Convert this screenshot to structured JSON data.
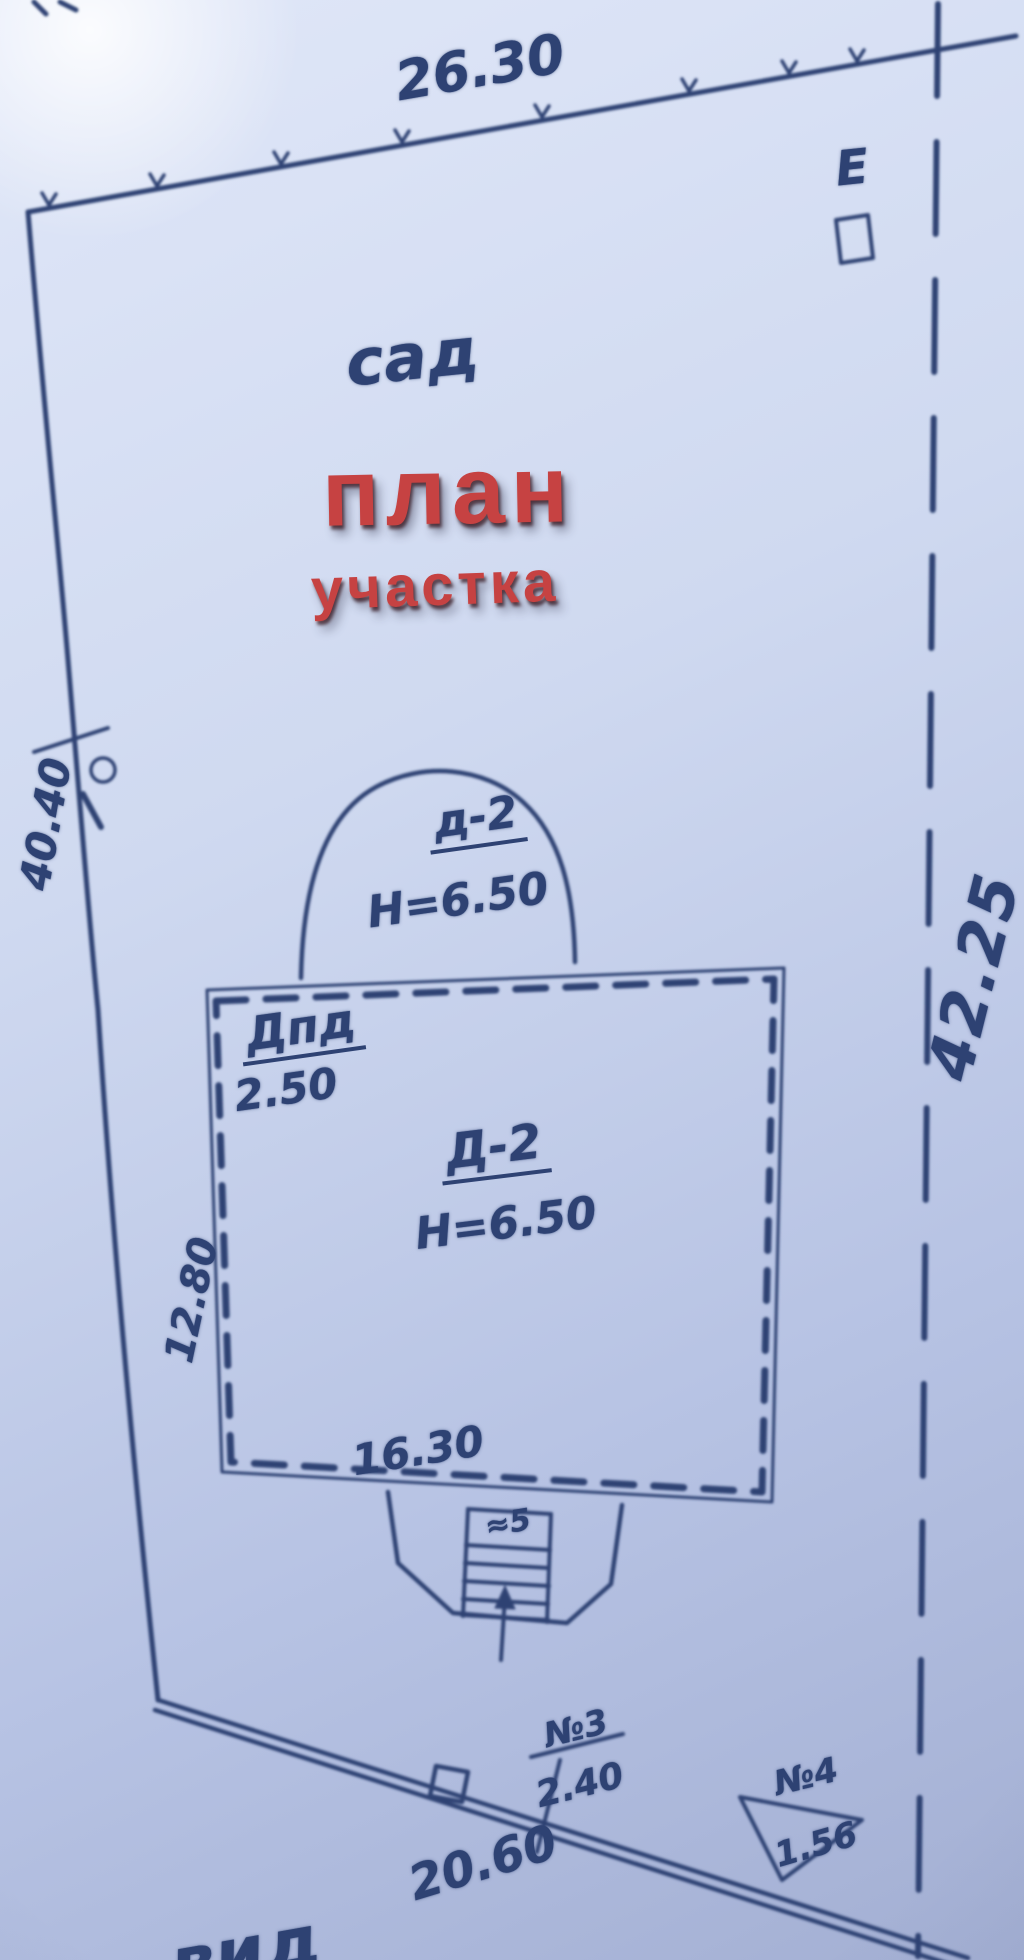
{
  "colors": {
    "ink": "#2e4273",
    "overlay_red": "#c64242",
    "paper": "#ccd6ee"
  },
  "overlay_title": {
    "line1": "план",
    "line2": "участка"
  },
  "annotations": {
    "garden_label": "сад",
    "corner_letter": "Е",
    "top_dimension": "26.30",
    "left_dimension": "40.40",
    "right_dimension": "42.25",
    "bottom_dimension": "20.60",
    "arch_name": "д-2",
    "arch_height": "Н=6.50",
    "house_annex_name": "Дпд",
    "house_annex_value": "2.50",
    "house_name": "Д-2",
    "house_height": "Н=6.50",
    "house_left_dimension": "12.80",
    "house_bottom_dimension": "16.30",
    "porch_mark": "≈5",
    "structure3_name": "№3",
    "structure3_value": "2.40",
    "structure4_name": "№4",
    "structure4_value": "1.56",
    "bottom_edge_partial_text": "вид"
  }
}
